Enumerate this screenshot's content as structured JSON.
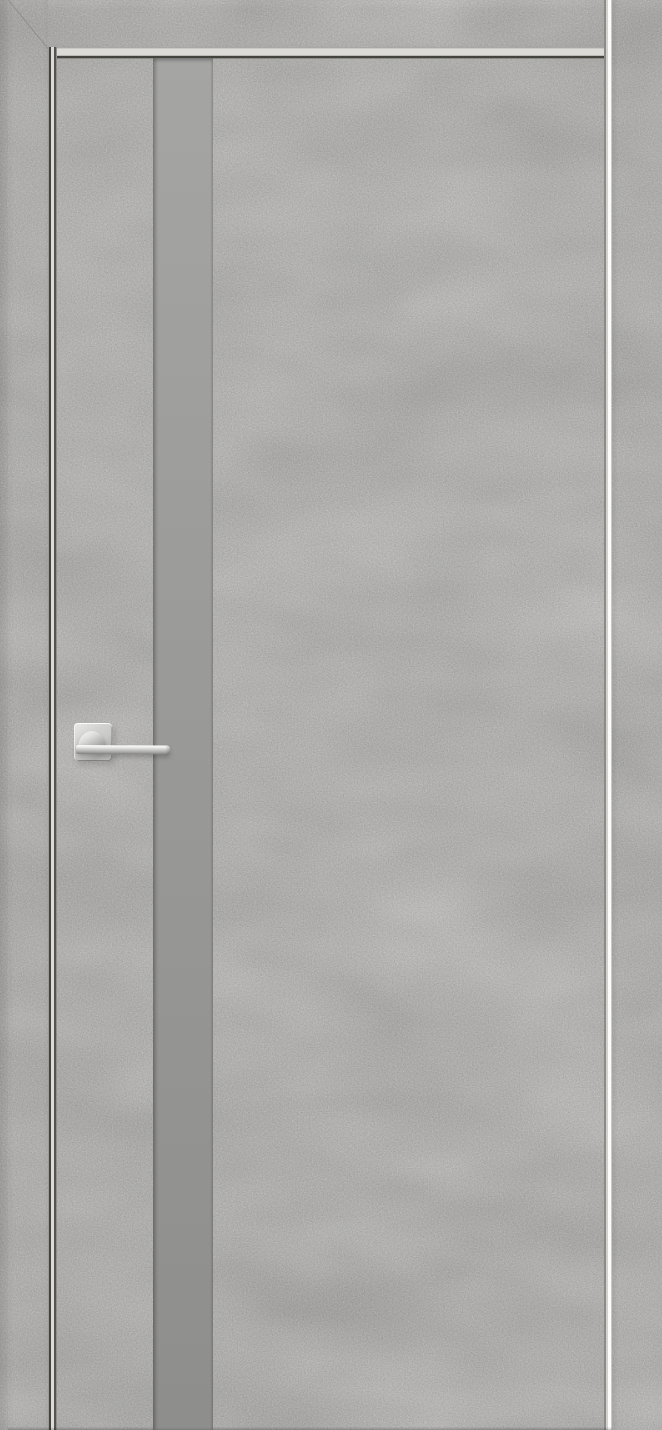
{
  "scene": {
    "kind": "product-photo",
    "subject": "interior-door-with-vertical-glass-insert-and-chrome-lever-handle"
  },
  "colors": {
    "wall": "#d0cfcd",
    "casing": "#e7e6e3",
    "door-face": "#eae9e6",
    "reveal-light": "#dcdbd8",
    "gap-dark": "#44443f",
    "edge-white": "#fbfbfa",
    "insert-top": "#a5a5a3",
    "insert-bottom": "#8e8e8c",
    "chrome-highlight": "#f7f7f5",
    "chrome-mid": "#c9c9c7",
    "chrome-shadow": "#8b8b89"
  },
  "parts": {
    "frame": "door-frame-casing",
    "leaf": "door-leaf",
    "insert": "glass-insert-strip",
    "handle": "lever-handle-on-square-rosette"
  }
}
